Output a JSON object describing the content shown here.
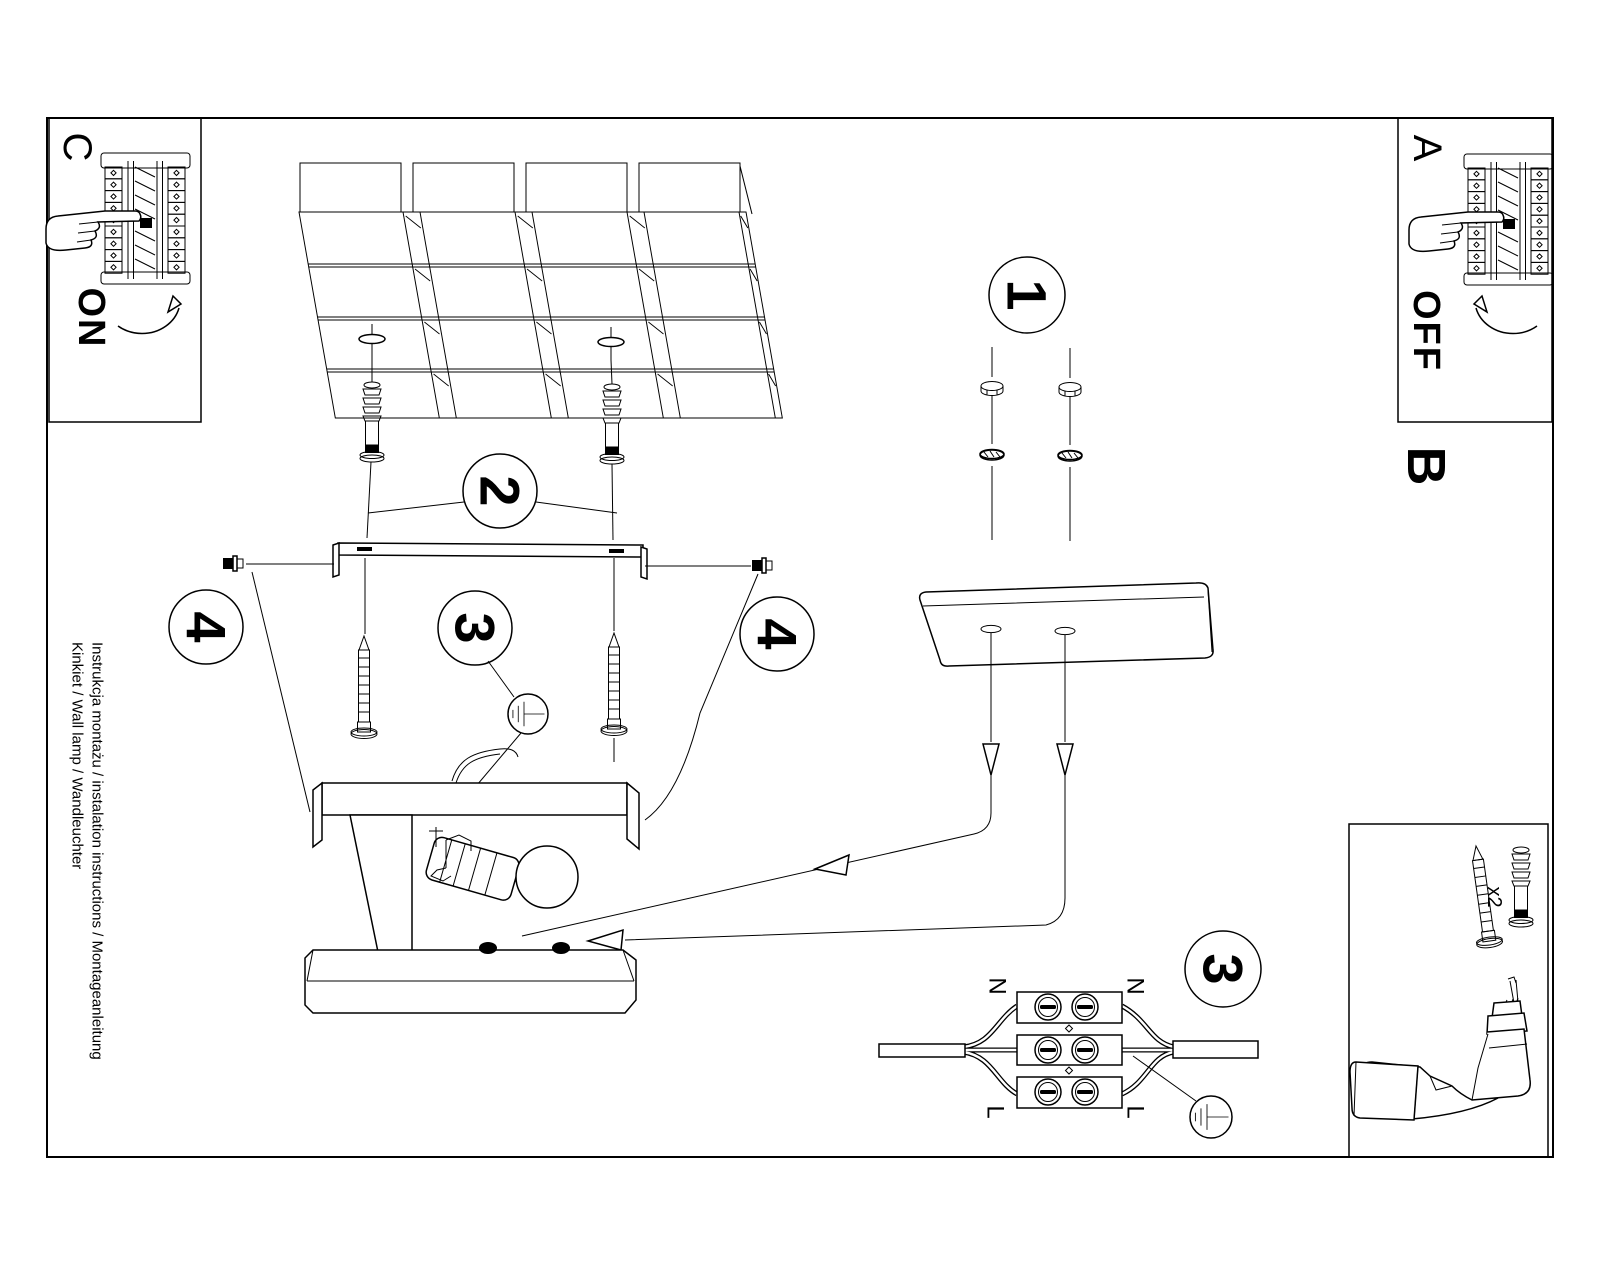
{
  "document": {
    "instructions_line": "Instrukcja montażu / instalation instructions / Montageanleitung",
    "product_line": "Kinkiet / Wall lamp / Wandleuchter"
  },
  "sections": {
    "power_off": {
      "label": "A",
      "switch_state": "OFF"
    },
    "mounting": {
      "label": "B"
    },
    "power_on": {
      "label": "C",
      "switch_state": "ON"
    }
  },
  "steps": {
    "step1": "1",
    "step2": "2",
    "step3_ground": "3",
    "step3_wiring": "3",
    "step4_left": "4",
    "step4_right": "4"
  },
  "wiring": {
    "neutral_left": "N",
    "neutral_right": "N",
    "live_left": "L",
    "live_right": "L"
  },
  "hardware": {
    "screw_pack_qty": "x2"
  },
  "colors": {
    "ink": "#000000",
    "paper": "#ffffff"
  }
}
